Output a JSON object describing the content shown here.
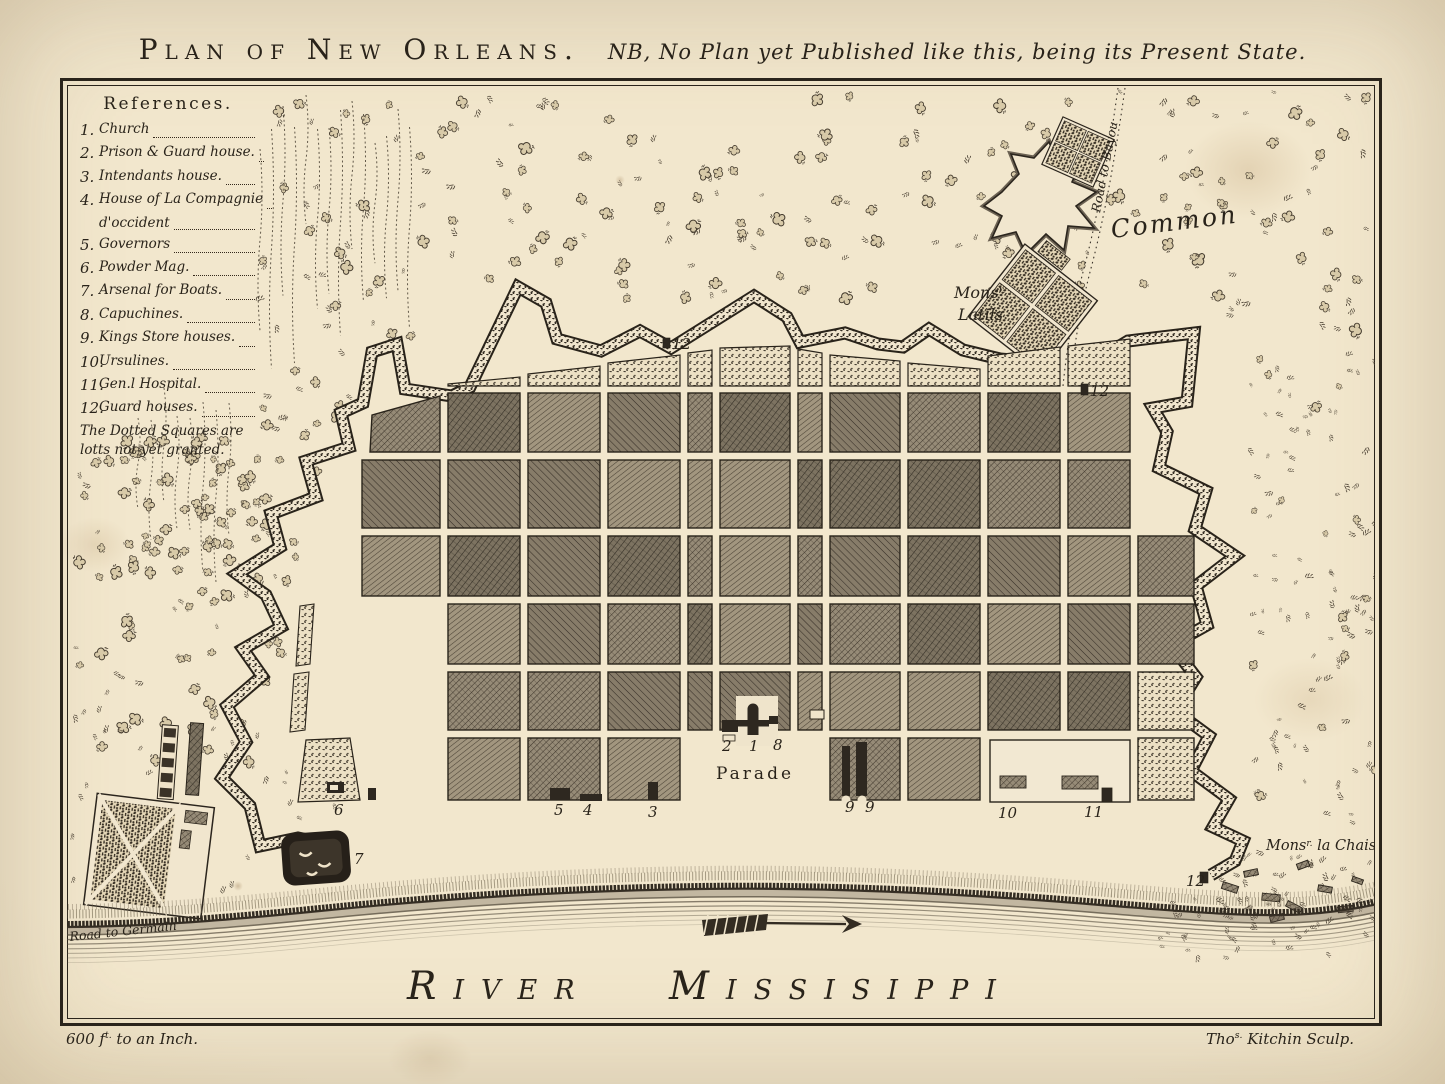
{
  "title": {
    "main": "Plan of New Orleans.",
    "subtitle": "NB, No Plan yet Published like this, being its Present State."
  },
  "references": {
    "heading": "References.",
    "items": [
      {
        "num": "1.",
        "label": "Church"
      },
      {
        "num": "2.",
        "label": "Prison & Guard house."
      },
      {
        "num": "3.",
        "label": "Intendants house."
      },
      {
        "num": "4.",
        "label": "House of La Compagnie",
        "label2": "d'occident"
      },
      {
        "num": "5.",
        "label": "Governors"
      },
      {
        "num": "6.",
        "label": "Powder Mag."
      },
      {
        "num": "7.",
        "label": "Arsenal for Boats."
      },
      {
        "num": "8.",
        "label": "Capuchines."
      },
      {
        "num": "9.",
        "label": "Kings Store houses."
      },
      {
        "num": "10.",
        "label": "Ursulines."
      },
      {
        "num": "11.",
        "label": "Gen.l Hospital."
      },
      {
        "num": "12.",
        "label": "Guard houses."
      }
    ],
    "note": "The Dotted Squares are lotts not yet granted."
  },
  "map_labels": {
    "common": "Common",
    "road_to_bayou": "Road to Bayou",
    "mons_latils": {
      "pre": "Mons",
      "sup": "r.",
      "line2": "Latils"
    },
    "parade": "Parade",
    "mons_la_chaise": {
      "pre": "Mons",
      "sup": "r.",
      "post": " la Chaise"
    },
    "road_to_germain": "Road to Germain",
    "river": "River Missisippi"
  },
  "markers": [
    {
      "text": "12",
      "x": 672,
      "y": 349
    },
    {
      "text": "12",
      "x": 1090,
      "y": 396
    },
    {
      "text": "12",
      "x": 1186,
      "y": 886
    },
    {
      "text": "2",
      "x": 722,
      "y": 751
    },
    {
      "text": "1",
      "x": 749,
      "y": 751
    },
    {
      "text": "8",
      "x": 773,
      "y": 750
    },
    {
      "text": "3",
      "x": 648,
      "y": 817
    },
    {
      "text": "4",
      "x": 583,
      "y": 815
    },
    {
      "text": "5",
      "x": 554,
      "y": 815
    },
    {
      "text": "6",
      "x": 334,
      "y": 815
    },
    {
      "text": "7",
      "x": 354,
      "y": 864
    },
    {
      "text": "9",
      "x": 845,
      "y": 812
    },
    {
      "text": "9",
      "x": 865,
      "y": 812
    },
    {
      "text": "10",
      "x": 998,
      "y": 818
    },
    {
      "text": "11",
      "x": 1084,
      "y": 817
    }
  ],
  "footer": {
    "scale": {
      "pre": "600 f",
      "sup": "t.",
      "post": " to an Inch."
    },
    "engraver": {
      "pre": "Tho",
      "sup": "s.",
      "post": " Kitchin Sculp."
    }
  },
  "colors": {
    "paper": "#efe4cb",
    "ink": "#29231a",
    "block_dark": "#877c69",
    "block_light": "#a2967f",
    "stipple_dot": "#3f372b"
  }
}
